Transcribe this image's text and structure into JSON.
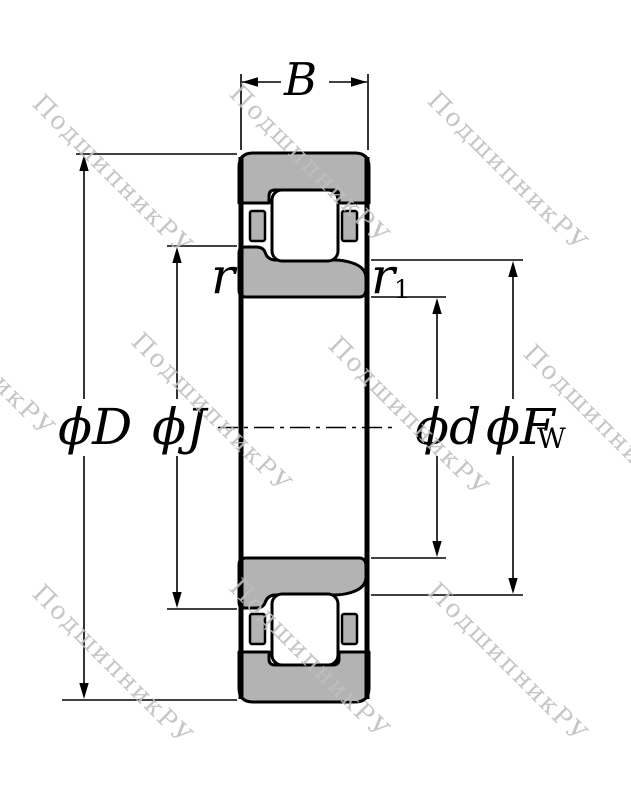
{
  "diagram": {
    "labels": {
      "width": "B",
      "outer_diameter": "ϕD",
      "inner_rib_diameter": "ϕJ",
      "bore_diameter": "ϕd",
      "raceway_diameter_main": "ϕF",
      "raceway_diameter_sub": "W",
      "chamfer_outer": "r",
      "chamfer_inner_main": "r",
      "chamfer_inner_sub": "1"
    },
    "colors": {
      "ring_fill": "#b3b3b3",
      "roller_fill": "#ffffff",
      "outline": "#000000",
      "watermark": "#c3c3c3"
    }
  },
  "watermark": {
    "text": "ПодшипникРУ"
  }
}
